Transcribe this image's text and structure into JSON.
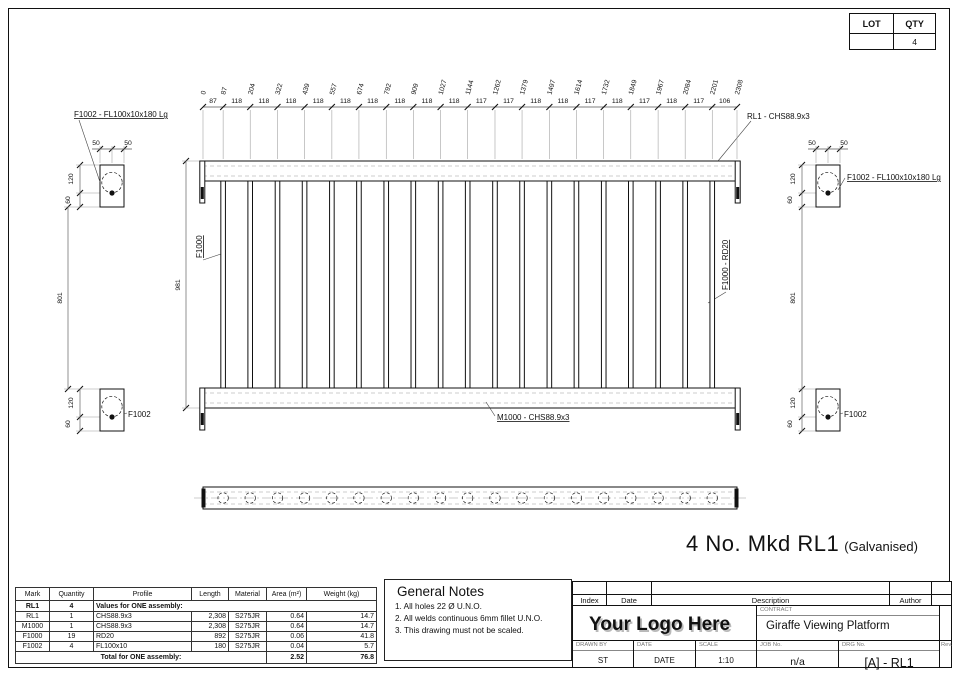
{
  "sheet": {
    "lot_label": "LOT",
    "qty_label": "QTY",
    "qty_value": "4"
  },
  "drawing": {
    "labels": {
      "plate_top_left": "F1002 - FL100x10x180 Lg",
      "plate_top_right": "F1002 - FL100x10x180 Lg",
      "top_rail": "RL1 - CHS88.9x3",
      "bottom_rail": "M1000 - CHS88.9x3",
      "baluster": "F1000",
      "baluster_right": "F1000 - RD20",
      "plate_bottom_left": "F1002",
      "plate_bottom_right": "F1002"
    },
    "dims": {
      "top_cumulative": [
        "0",
        "87",
        "204",
        "322",
        "439",
        "557",
        "674",
        "792",
        "909",
        "1027",
        "1144",
        "1262",
        "1379",
        "1497",
        "1614",
        "1732",
        "1849",
        "1967",
        "2084",
        "2201",
        "2308"
      ],
      "top_segments": [
        "87",
        "118",
        "118",
        "118",
        "118",
        "118",
        "118",
        "118",
        "118",
        "118",
        "117",
        "117",
        "118",
        "118",
        "117",
        "118",
        "117",
        "118",
        "117",
        "106"
      ],
      "overall_height": "981",
      "gap_left": "801",
      "gap_right": "801",
      "fifty": "50",
      "one_twenty": "120",
      "sixty": "60"
    },
    "caption": {
      "main": "4 No. Mkd RL1",
      "suffix": "(Galvanised)"
    }
  },
  "notes": {
    "title": "General Notes",
    "items": [
      "1.  All holes 22 Ø U.N.O.",
      "2.  All welds continuous 6mm fillet U.N.O.",
      "3.  This drawing must not be scaled."
    ]
  },
  "bom": {
    "headers": [
      "Mark",
      "Quantity",
      "Profile",
      "Length",
      "Material",
      "Area (m²)",
      "Weight (kg)"
    ],
    "group": {
      "mark": "RL1",
      "qty": "4",
      "label": "Values for ONE assembly:"
    },
    "rows": [
      [
        "RL1",
        "1",
        "CHS88.9x3",
        "2,308",
        "S275JR",
        "0.64",
        "14.7"
      ],
      [
        "M1000",
        "1",
        "CHS88.9x3",
        "2,308",
        "S275JR",
        "0.64",
        "14.7"
      ],
      [
        "F1000",
        "19",
        "RD20",
        "892",
        "S275JR",
        "0.06",
        "41.8"
      ],
      [
        "F1002",
        "4",
        "FL100x10",
        "180",
        "S275JR",
        "0.04",
        "5.7"
      ]
    ],
    "total": {
      "label": "Total for ONE assembly:",
      "area": "2.52",
      "weight": "76.8"
    }
  },
  "titleblock": {
    "rev_headers": {
      "index": "Index",
      "date": "Date",
      "description": "Description",
      "author": "Author"
    },
    "logo": "Your Logo Here",
    "contract_label": "CONTRACT",
    "contract": "Giraffe Viewing Platform",
    "drawn_label": "DRAWN  BY",
    "drawn": "ST",
    "date_label": "DATE",
    "date_value": "DATE",
    "scale_label": "SCALE",
    "scale": "1:10",
    "job_label": "JOB  No.",
    "job": "n/a",
    "drg_label": "DRG  No.",
    "drg": "[A] - RL1",
    "rev_label": "Rev."
  }
}
